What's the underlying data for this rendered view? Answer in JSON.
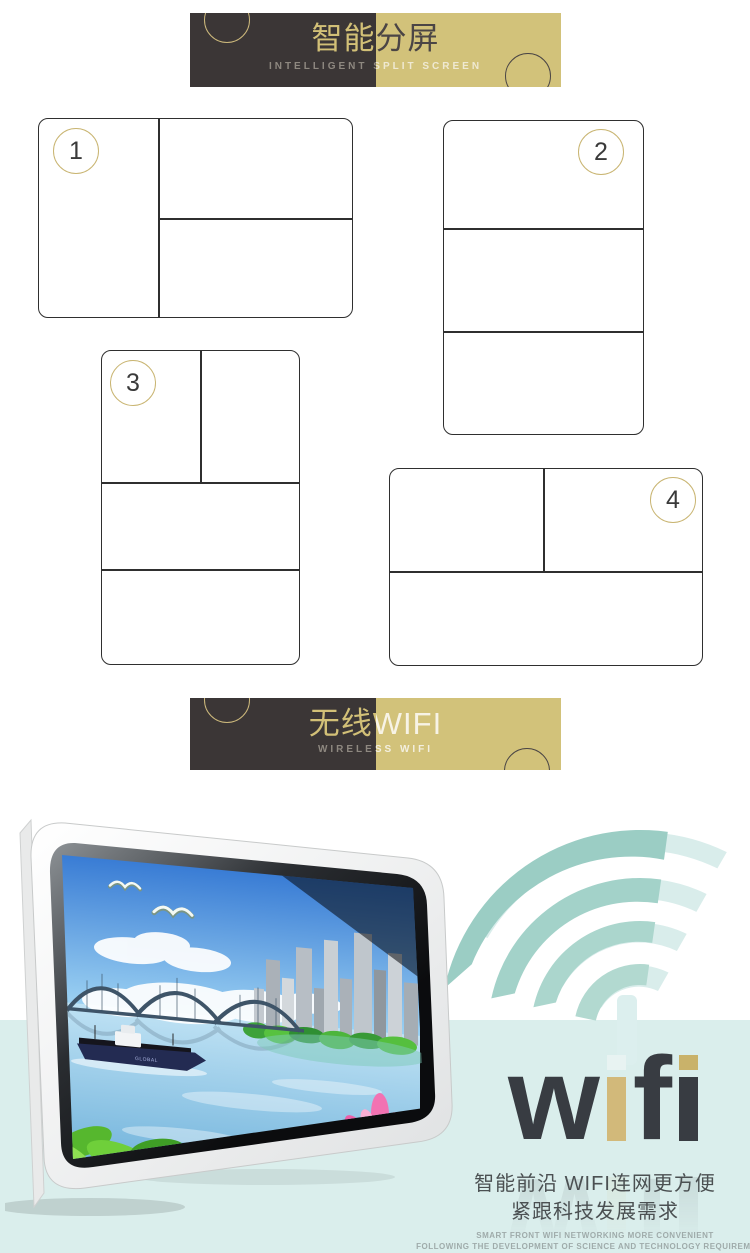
{
  "page": {
    "background": "#ffffff",
    "band_color": "#daeeec"
  },
  "banner_split": {
    "title": "智能分屏",
    "subtitle": "INTELLIGENT SPLIT SCREEN",
    "dark_color": "#3b3636",
    "gold_color": "#d2c27a"
  },
  "banner_wifi": {
    "title": "无线WIFI",
    "subtitle": "WIRELESS WIFI"
  },
  "diagrams": [
    {
      "number": "1",
      "layout": "left column + right split top/bottom"
    },
    {
      "number": "2",
      "layout": "three stacked rows"
    },
    {
      "number": "3",
      "layout": "top split left/right + two rows"
    },
    {
      "number": "4",
      "layout": "top split left/right + bottom row"
    }
  ],
  "wifi_art": {
    "letters": [
      "w",
      "i",
      "f",
      "i"
    ],
    "dark": "#383c42",
    "gold": "#d2b97a",
    "dot_light": "#e8f3f2",
    "arc_teal": "#9fcfc6",
    "arc_light": "#d9edeb"
  },
  "monitor": {
    "ship_label": "GLOBAL"
  },
  "footer": {
    "line1": "智能前沿 WIFI连网更方便",
    "line2": "紧跟科技发展需求",
    "line3": "SMART FRONT WIFI NETWORKING MORE CONVENIENT",
    "line4": "FOLLOWING THE DEVELOPMENT OF SCIENCE AND TECHNOLOGY REQUIREMENTS"
  }
}
